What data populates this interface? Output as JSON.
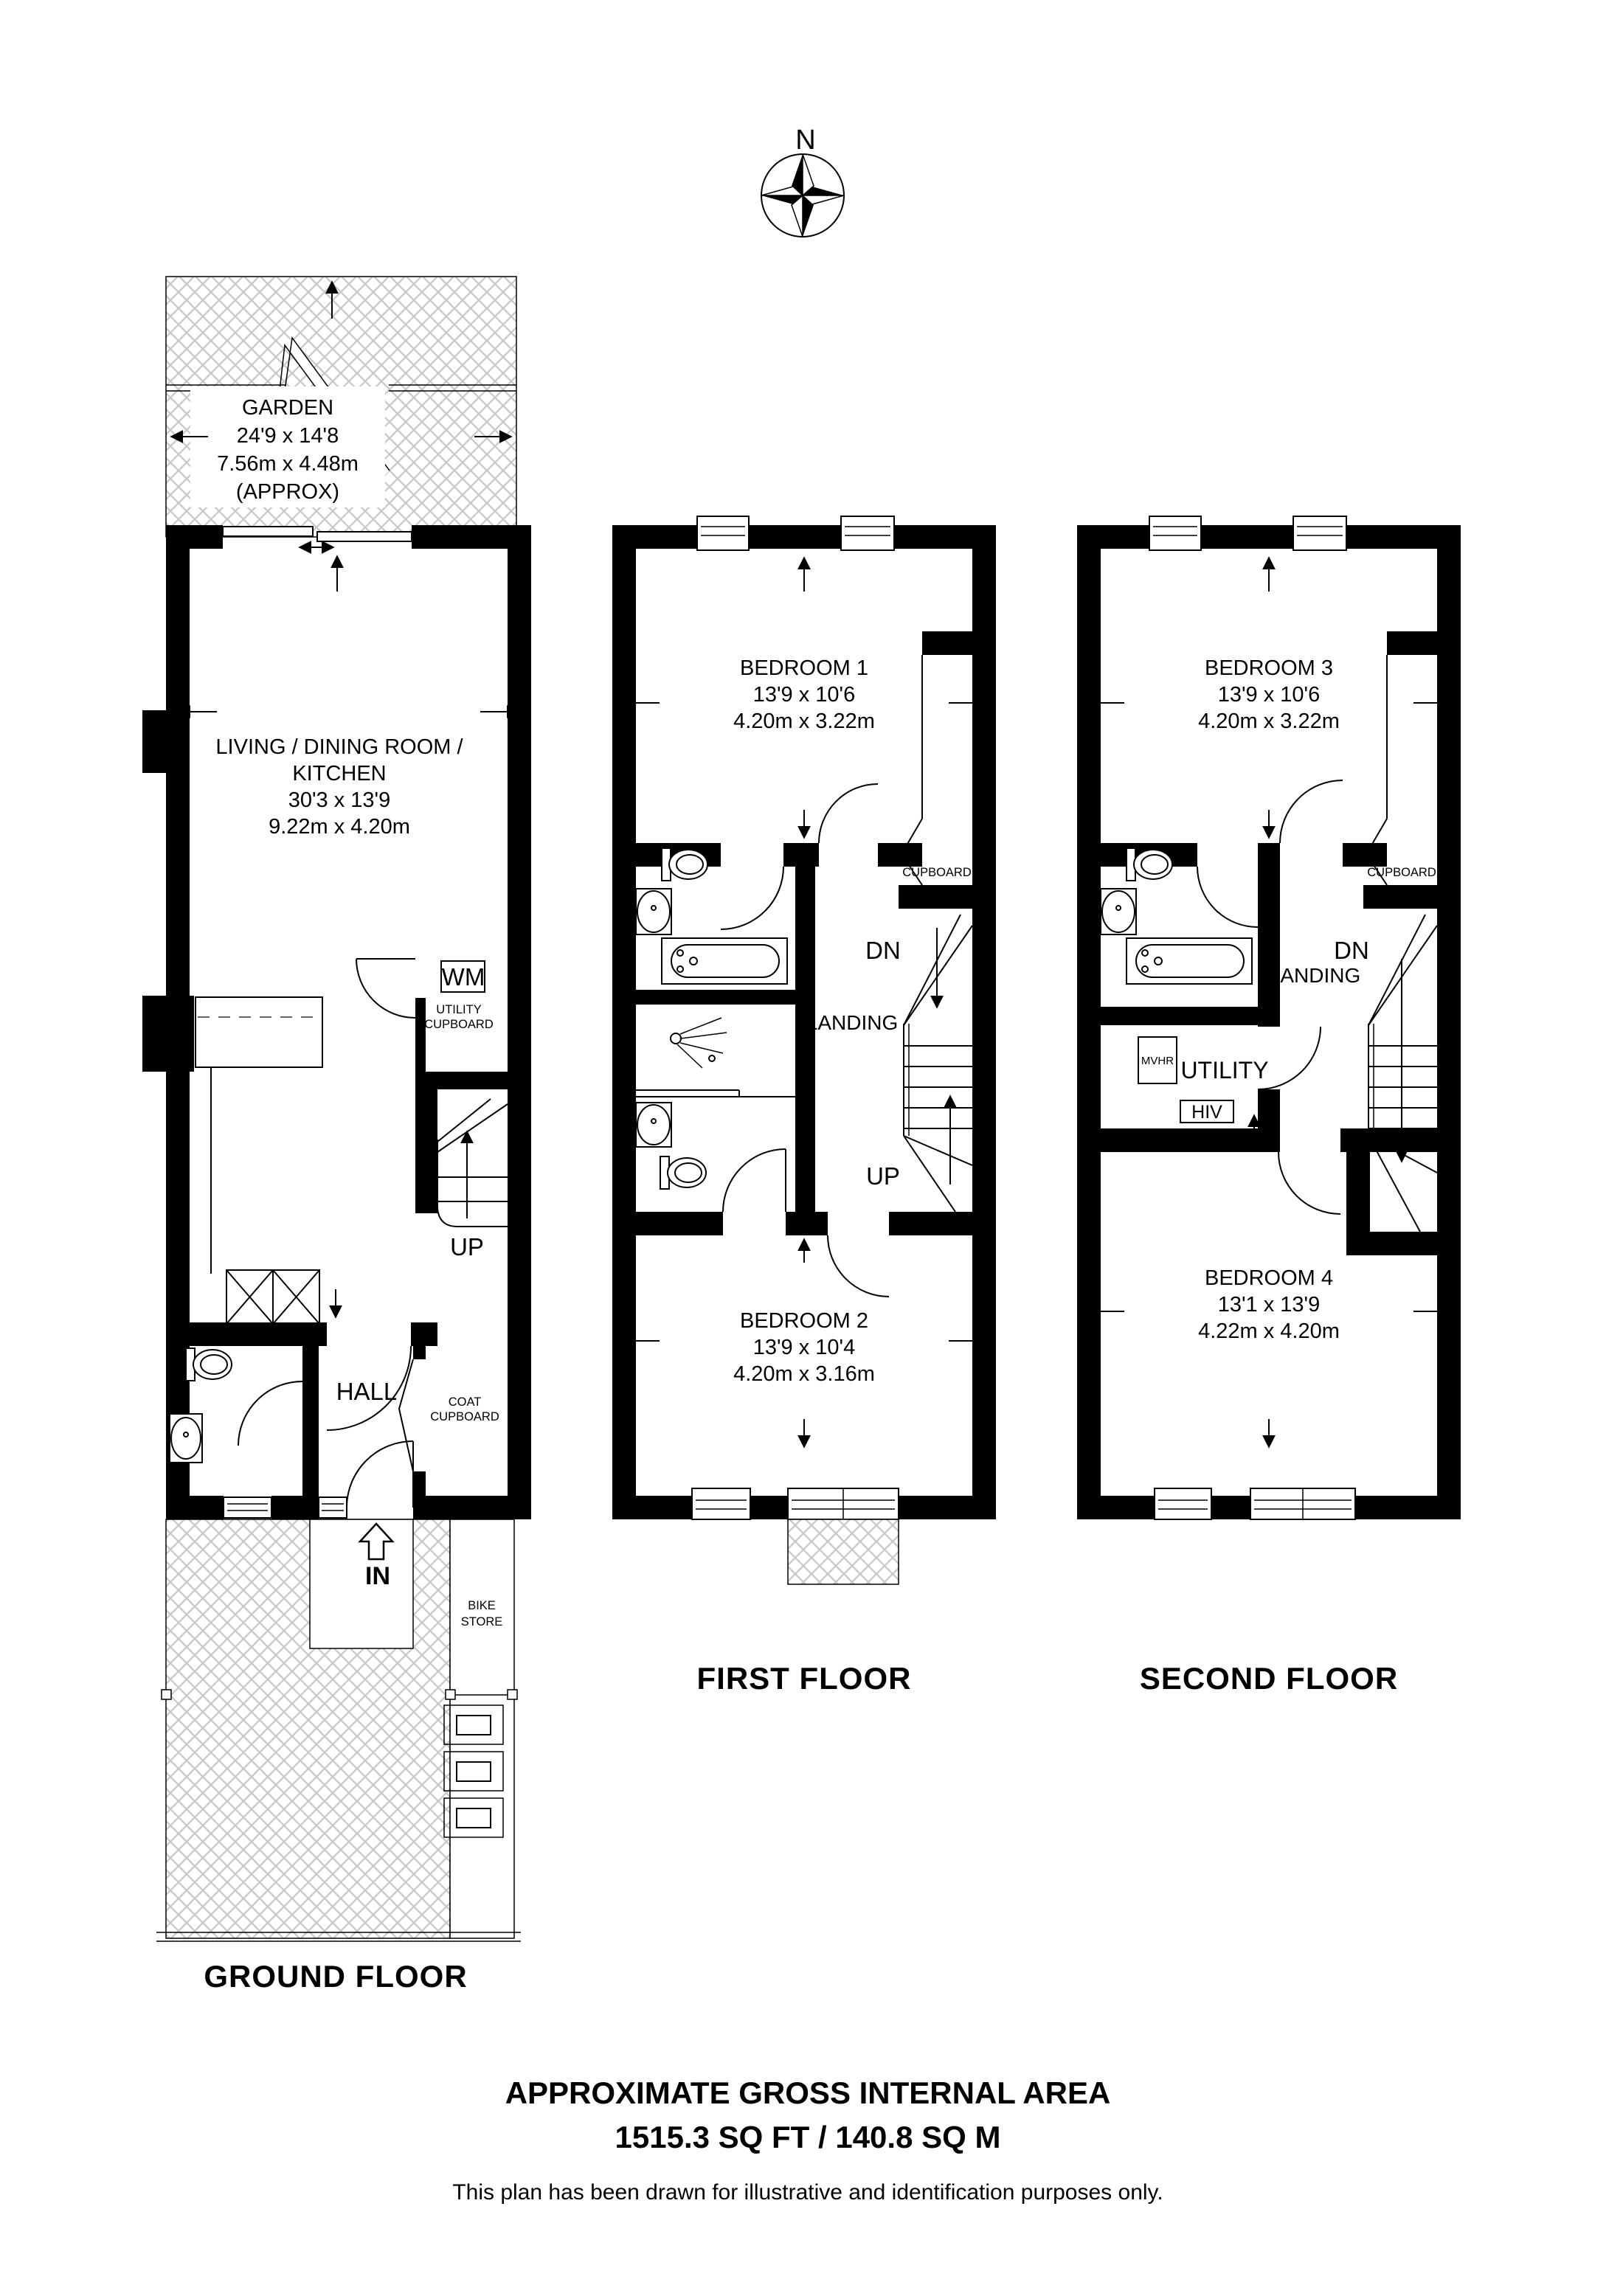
{
  "compass": {
    "north_label": "N"
  },
  "ground_floor": {
    "floor_label": "GROUND FLOOR",
    "garden": {
      "name": "GARDEN",
      "imperial": "24'9 x 14'8",
      "metric": "7.56m x 4.48m",
      "approx": "(APPROX)"
    },
    "living_dining_kitchen": {
      "name_line1": "LIVING / DINING ROOM /",
      "name_line2": "KITCHEN",
      "imperial": "30'3 x 13'9",
      "metric": "9.22m x 4.20m"
    },
    "washing_machine": "WM",
    "utility_cupboard": {
      "line1": "UTILITY",
      "line2": "CUPBOARD"
    },
    "stairs": "UP",
    "hall": "HALL",
    "coat_cupboard": {
      "line1": "COAT",
      "line2": "CUPBOARD"
    },
    "entrance": "IN",
    "bike_store": {
      "line1": "BIKE",
      "line2": "STORE"
    }
  },
  "first_floor": {
    "floor_label": "FIRST FLOOR",
    "bedroom_1": {
      "name": "BEDROOM 1",
      "imperial": "13'9 x 10'6",
      "metric": "4.20m x 3.22m"
    },
    "bedroom_2": {
      "name": "BEDROOM 2",
      "imperial": "13'9 x 10'4",
      "metric": "4.20m x 3.16m"
    },
    "cupboard": "CUPBOARD",
    "landing": "LANDING",
    "down": "DN",
    "up": "UP"
  },
  "second_floor": {
    "floor_label": "SECOND FLOOR",
    "bedroom_3": {
      "name": "BEDROOM 3",
      "imperial": "13'9 x 10'6",
      "metric": "4.20m x 3.22m"
    },
    "bedroom_4": {
      "name": "BEDROOM 4",
      "imperial": "13'1 x 13'9",
      "metric": "4.22m x 4.20m"
    },
    "cupboard": "CUPBOARD",
    "landing": "LANDING",
    "down": "DN",
    "utility": "UTILITY",
    "mvhr": "MVHR",
    "hiu": "HIV"
  },
  "footer": {
    "area_title": "APPROXIMATE GROSS INTERNAL AREA",
    "area_value": "1515.3 SQ FT / 140.8 SQ M",
    "disclaimer": "This plan has been drawn for illustrative and identification purposes only."
  }
}
